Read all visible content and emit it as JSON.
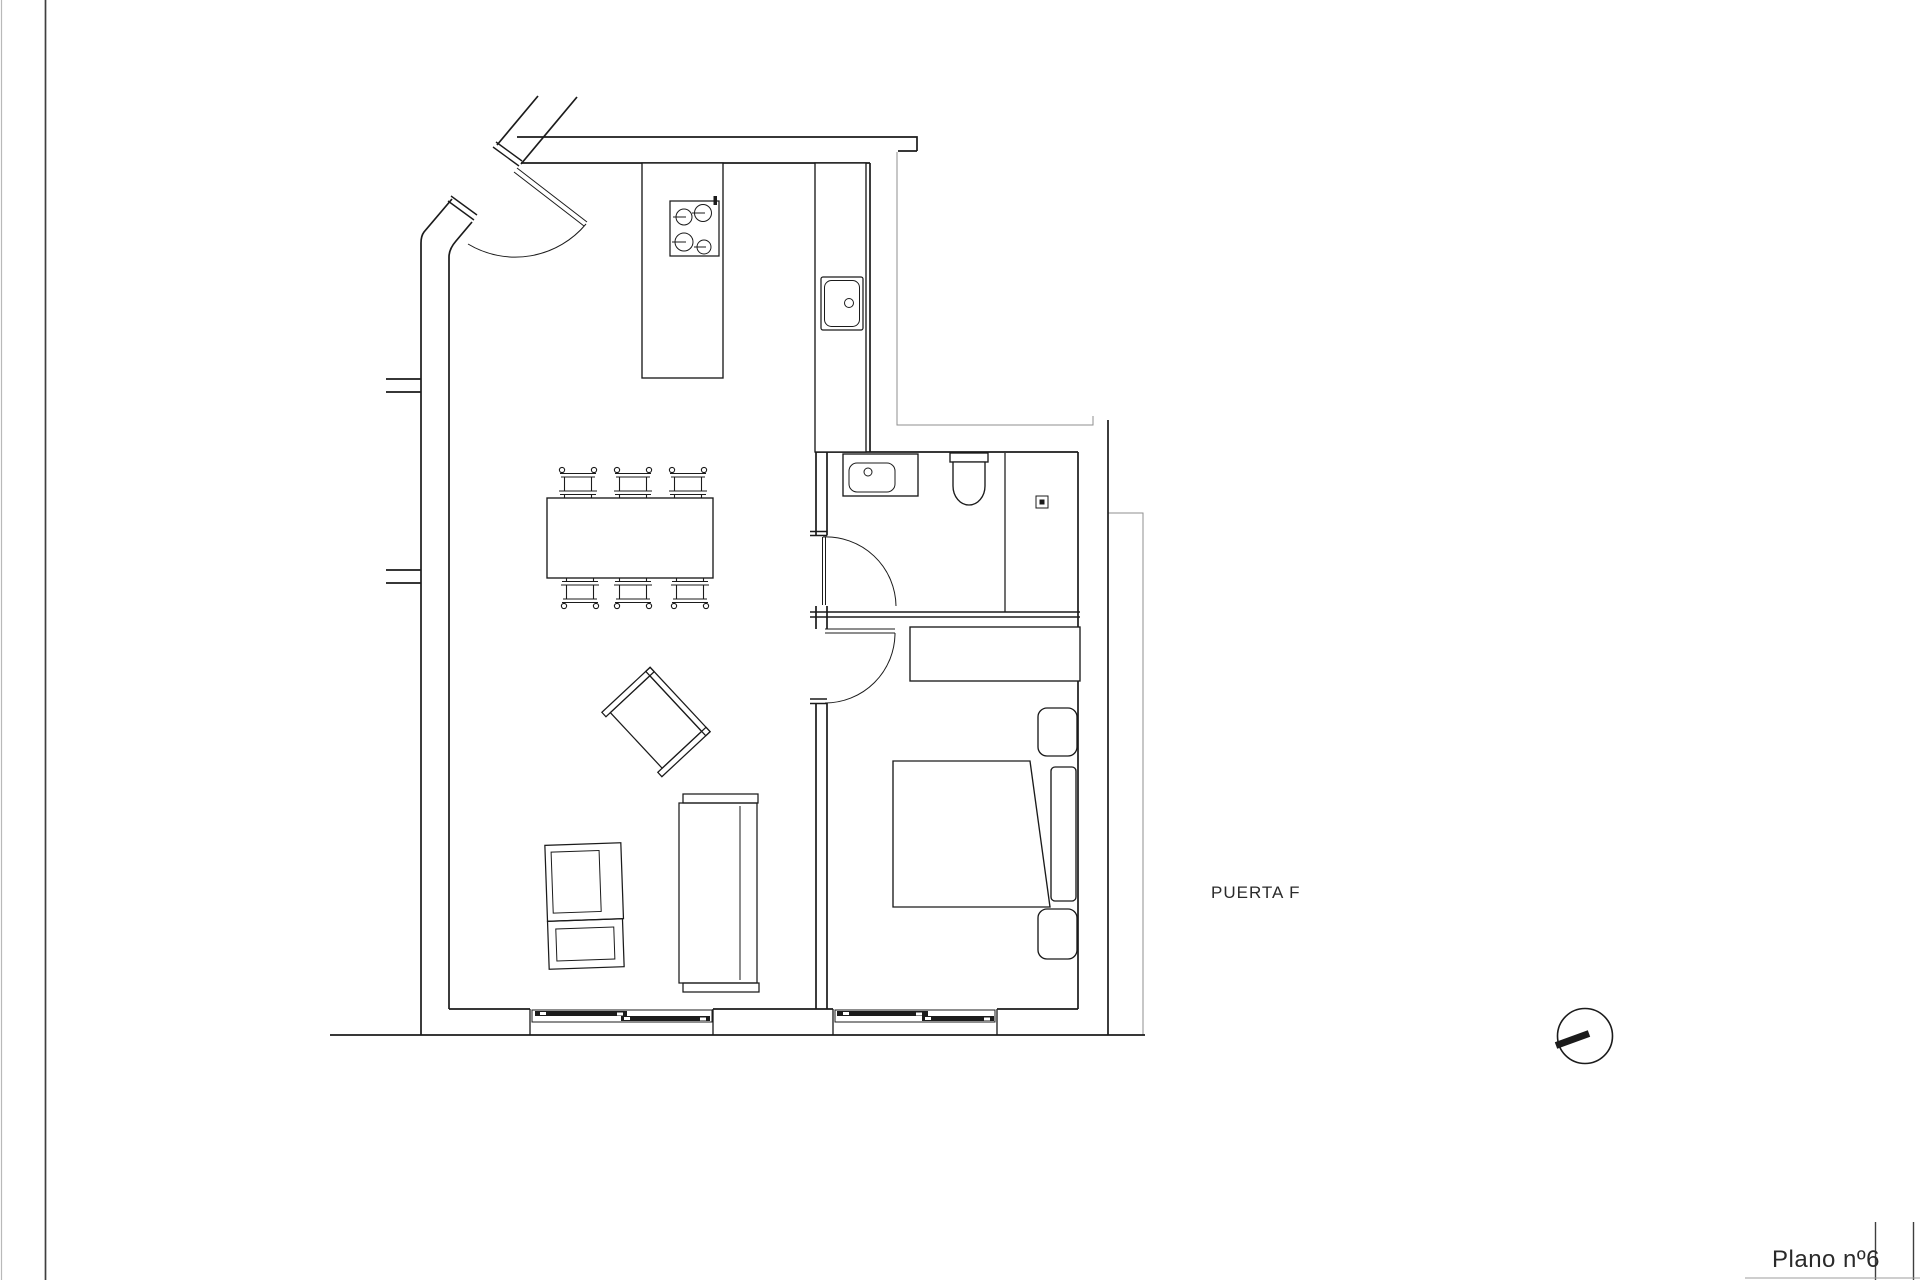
{
  "theme": {
    "bg": "#ffffff",
    "line": "#1b1b1b",
    "thin": "#8f8f8f",
    "edge": "#3f3f3f",
    "text": "#2a2a2a"
  },
  "labels": {
    "door": "PUERTA F",
    "sheet_number": "Plano nº6"
  }
}
